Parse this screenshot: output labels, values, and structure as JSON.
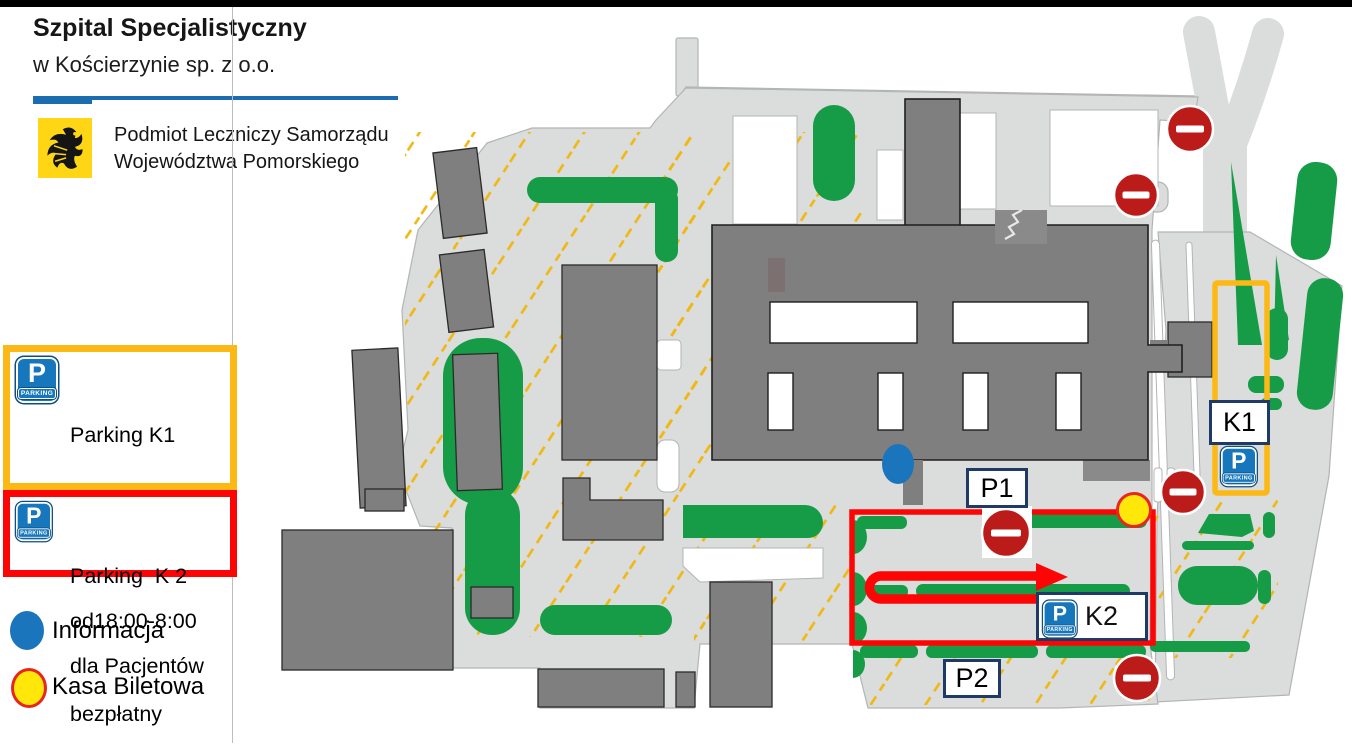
{
  "header": {
    "title": "Szpital Specjalistyczny",
    "subtitle": "w Kościerzynie sp. z o.o.",
    "org_line1": "Podmiot Leczniczy Samorządu",
    "org_line2": "Województwa Pomorskiego"
  },
  "legend": {
    "parking_k1": {
      "line1": "Parking K1",
      "line2": "dla Pacjentów",
      "line3": "od18:00-8:00",
      "line4": "bezpłatny"
    },
    "parking_k2": {
      "line1": "Parking  K 2",
      "line2": "dla Pacjentów"
    },
    "informacja": "Informacja",
    "kasa_biletowa": "Kasa Biletowa"
  },
  "parking_sign": {
    "letter": "P",
    "caption": "PARKING"
  },
  "map": {
    "labels": {
      "p1": "P1",
      "p2": "P2",
      "k1": "K1",
      "k2": "K2"
    },
    "colors": {
      "ground": "#dbdcdc",
      "building": "#7f7f7f",
      "green": "#169c47",
      "hatch": "#f0b70f",
      "k1_outline": "#fcb814",
      "k2_outline": "#fe0505",
      "no_entry_red": "#bb1b19",
      "info_blue": "#1b75bc",
      "kasa_fill": "#ffe70a",
      "kasa_border": "#e8251f",
      "accent_blue": "#1b6db0",
      "logo_yellow": "#ffd616"
    }
  }
}
